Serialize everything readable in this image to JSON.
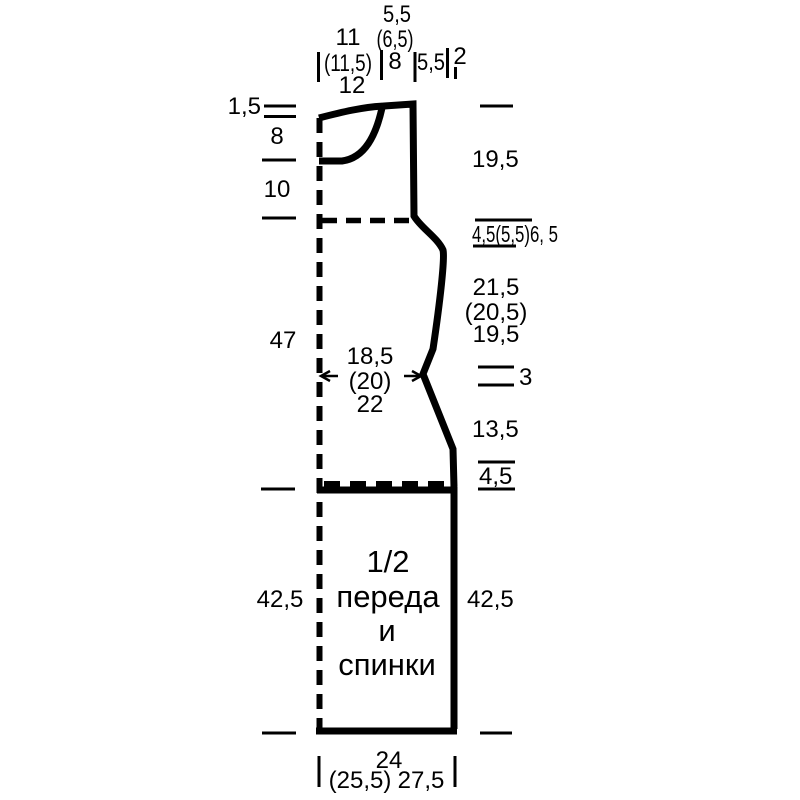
{
  "diagram": {
    "kind": "knitting pattern schematic",
    "colors": {
      "ink": "#000000",
      "background": "#ffffff"
    },
    "piece_label": [
      "1/2",
      "переда",
      "и",
      "спинки"
    ],
    "top": {
      "neck_width": [
        "11",
        "(11,5)",
        "12"
      ],
      "shoulder_slope": [
        "5,5",
        "(6,5)",
        "8"
      ],
      "shoulder_width": "5,5",
      "armhole_offset": "2"
    },
    "left": {
      "back_neck_depth": "1,5",
      "front_neck_depth": "8",
      "neck_to_armhole": "10",
      "armhole_to_hip": "47",
      "hip_to_hem": "42,5"
    },
    "right": {
      "armhole_depth": "19,5",
      "underarm_bindoff": "4,5(5,5)6, 5",
      "armhole_to_waist": [
        "21,5",
        "(20,5)",
        "19,5"
      ],
      "waist_marker": "3",
      "waist_to_hip": "13,5",
      "hip_bindoff": "4,5",
      "hip_to_hem": "42,5"
    },
    "waist_width": [
      "18,5",
      "(20)",
      "22"
    ],
    "bottom": {
      "hem_width_main": "24",
      "hem_width_alt1": "(25,5)",
      "hem_width_alt2": "27,5"
    }
  }
}
